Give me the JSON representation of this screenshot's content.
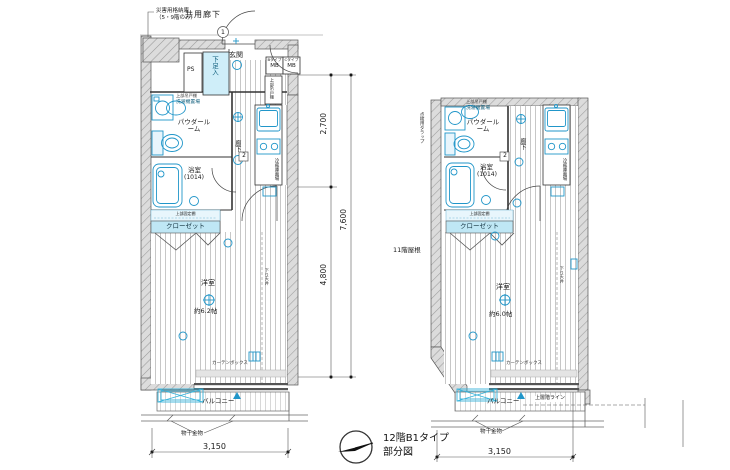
{
  "title": {
    "line1": "12階B1タイプ",
    "line2": "部分図"
  },
  "dims": {
    "w_left": "3,150",
    "w_right": "3,150",
    "h_upper": "2,700",
    "h_lower": "4,800",
    "h_total": "7,600"
  },
  "labels": {
    "corridor": "共用廊下",
    "disaster1": "災害用格納庫",
    "disaster2": "（5・9階のみ）",
    "entrance": "玄関",
    "shoe": "下足入",
    "ps": "PS",
    "mb_b_type": "Bタイプ",
    "mb_b": "MB",
    "mb_c_type": "Cタイプ",
    "mb_c": "MB",
    "upper_cabinet": "上部吊戸棚",
    "washer": "洗濯機置場",
    "powder": "パウダールーム",
    "bath": "浴室",
    "bath_size": "(1014)",
    "hall": "廊下",
    "fridge": "冷蔵庫置場",
    "shelf": "上部固定棚",
    "closet": "クローゼット",
    "room": "洋室",
    "room_size_left": "約6.2帖",
    "room_size_right": "約6.0帖",
    "down_ceiling": "下り天井",
    "curtain_box": "カーテンボックス",
    "balcony": "バルコニー",
    "laundry": "物干金物",
    "upper_floor_line": "上層階ライン",
    "trap": "点検用タラップ",
    "roof": "11階屋根",
    "hatch_num": "1",
    "door_num": "2"
  },
  "colors": {
    "fixture": "#2196c9",
    "band": "#bfe7f5",
    "band_light": "#e8f6fc",
    "wall": "#d9d9d9"
  }
}
